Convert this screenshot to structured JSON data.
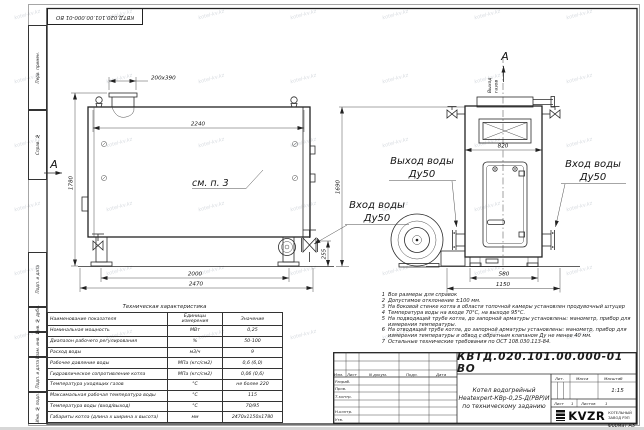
{
  "watermark": "kotel-kv.kz",
  "stamp_top": "КВТД.020.101.00.000-01 ВО",
  "margin": {
    "cells": [
      {
        "label": "Перв. примен."
      },
      {
        "label": "Справ. №"
      },
      {
        "label": "Подп. и дата"
      },
      {
        "label": "Инв. № дубл."
      },
      {
        "label": "Взам. инв. №"
      },
      {
        "label": "Подп. и дата"
      },
      {
        "label": "Инв. № подл."
      }
    ]
  },
  "side": {
    "section_label": "А",
    "see_note": "см. п. 3",
    "dims": {
      "stub": "200х390",
      "width": "2240",
      "height": "1780",
      "legs": "2000",
      "length": "2470",
      "valve_h": "255",
      "front_h": "1690"
    }
  },
  "front": {
    "view_label": "А",
    "gas_line1": "Выход",
    "gas_line2": "газов",
    "dims": {
      "top": "820",
      "base": "580",
      "width": "1150"
    }
  },
  "labels": {
    "water_out": "Выход воды",
    "water_out_dn": "Ду50",
    "water_in_r": "Вход воды",
    "water_in_r_dn": "Ду50",
    "water_in_l": "Вход воды",
    "water_in_l_dn": "Ду50"
  },
  "notes": [
    {
      "n": "1",
      "text": "Все размеры для справок"
    },
    {
      "n": "2",
      "text": "Допустимое отклонение ±100 мм."
    },
    {
      "n": "3",
      "text": "На боковой стенке котла в области топочной камеры установлен продувочный штуцер"
    },
    {
      "n": "4",
      "text": "Температура воды на входе 70°С, на выходе 95°С."
    },
    {
      "n": "5",
      "text": "На подводящей трубе котла, до запорной арматуры установлены: манометр, прибор для измерения температуры."
    },
    {
      "n": "6",
      "text": "На отводящей трубе котла, до запорной арматуры установлены: манометр, прибор для измерения температуры и обвод с обратным клапаном Ду не менее 40 мм."
    },
    {
      "n": "7",
      "text": "Остальные технические требования по ОСТ 108.030.113-84."
    }
  ],
  "spec": {
    "title": "Техническая характеристика",
    "headers": {
      "name": "Наименование показателя",
      "unit1": "Единицы",
      "unit2": "измерения",
      "value": "Значение"
    },
    "rows": [
      {
        "name": "Номинальная мощность",
        "unit": "МВт",
        "value": "0,25"
      },
      {
        "name": "Диапазон рабочего регулирования",
        "unit": "%",
        "value": "50-100"
      },
      {
        "name": "Расход воды",
        "unit": "м3/ч",
        "value": "9"
      },
      {
        "name": "Рабочее давление воды",
        "unit": "МПа (кгс/см2)",
        "value": "0,6 (6,0)"
      },
      {
        "name": "Гидравлическое сопротивление котла",
        "unit": "МПа (кгс/см2)",
        "value": "0,06 (0,6)"
      },
      {
        "name": "Температура уходящих газов",
        "unit": "°С",
        "value": "не более 220"
      },
      {
        "name": "Максимальная рабочая температура воды",
        "unit": "°С",
        "value": "115"
      },
      {
        "name": "Температура воды (вход/выход)",
        "unit": "°С",
        "value": "70/95"
      },
      {
        "name": "Габариты котла (длина х ширина х высота)",
        "unit": "мм",
        "value": "2470х1150х1780"
      }
    ]
  },
  "title_block": {
    "doc_number": "КВТД.020.101.00.000-01 ВО",
    "product_line1": "Котел водогрейный",
    "product_line2": "Heatexpert-КВр-0,25-Д(РВР)И",
    "product_line3": "по техническому заданию",
    "col_izm": "Изм.",
    "col_list": "Лист",
    "col_doc": "N докум.",
    "col_sign": "Подп.",
    "col_date": "Дата",
    "row_dev": "Разраб.",
    "row_check": "Пров.",
    "row_tcontr": "Т.контр.",
    "row_ncontr": "Н.контр.",
    "row_approve": "Утв.",
    "lit_label": "Лит.",
    "mass_label": "Масса",
    "scale_label": "Масштаб",
    "scale_value": "1:15",
    "sheet_label": "Лист",
    "sheet_value": "1",
    "sheets_label": "Листов",
    "sheets_value": "1",
    "logo_word": "KVZR",
    "company_line1": "КОТЕЛЬНЫЙ",
    "company_line2": "ЗАВОД РЭП",
    "format_label": "Формат",
    "format_value": "А3"
  }
}
